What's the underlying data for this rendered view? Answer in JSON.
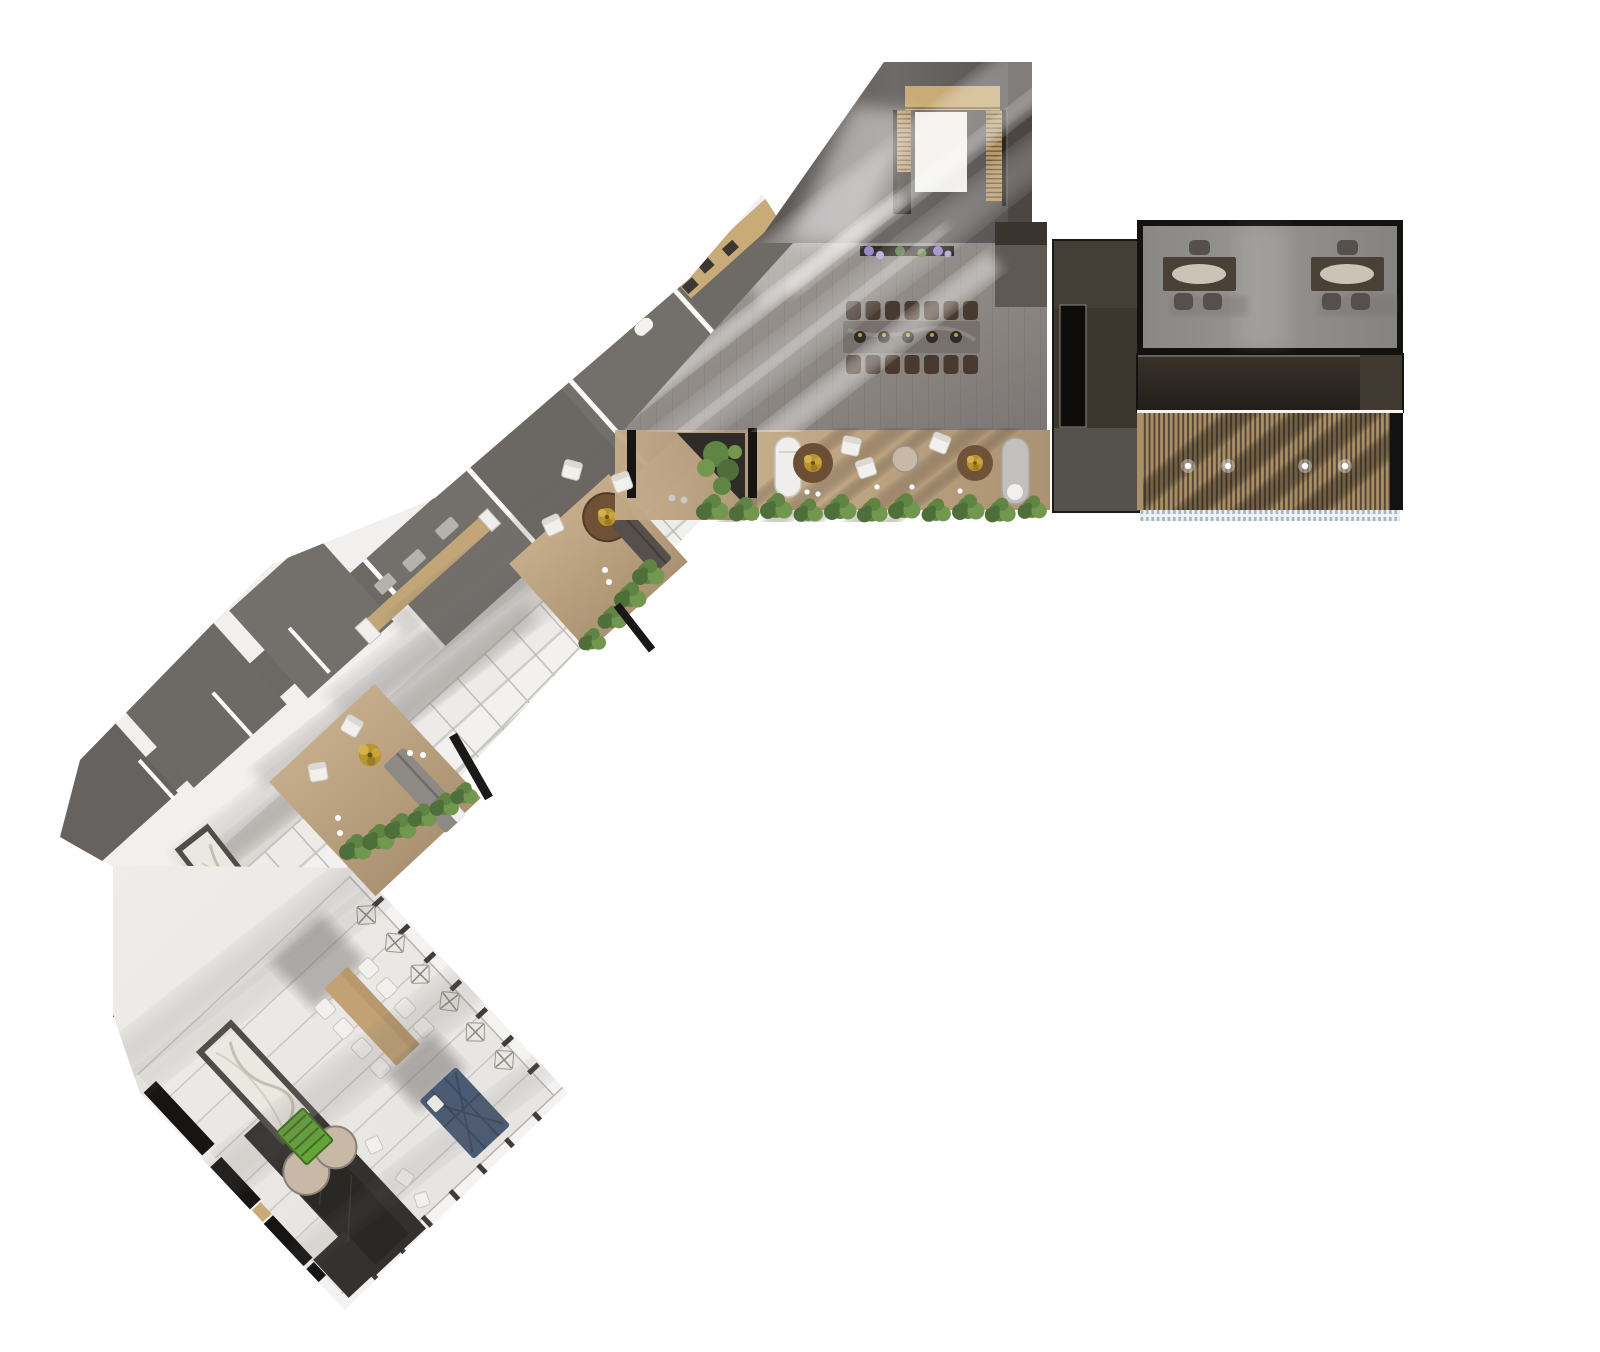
{
  "meta": {
    "title": "Rendered top-view architectural floor plan",
    "view": "orthographic roof-level render, V-shaped building on white background",
    "canvas": {
      "width": 1600,
      "height": 1352
    }
  },
  "palette": {
    "background": "#ffffff",
    "hall_light": "#a29c97",
    "hall_dark": "#7d7874",
    "troom_light": "#716d6a",
    "troom_dark": "#565150",
    "wood_light": "#c9ab78",
    "wood_counter": "#c2a678",
    "deck_light": "#c5ac8a",
    "deck_dark": "#ab9272",
    "rooms_gray": "#73706c",
    "rooms_gray_dark": "#67635f",
    "white_panel": "#f1f0ee",
    "panel_joint": "#c2bfba",
    "walkway": "#dcd9d5",
    "meeting_floor": "#8f8d8a",
    "desk_brown": "#4a4136",
    "desk_glow": "#d8d1c4",
    "chair_gray": "#55504c",
    "chair_dark": "#483a30",
    "white_chair": "#f1f0ed",
    "dark_band": "#2d2721",
    "corridor": "#3c362f",
    "corridor_light": "#55504d",
    "black_panel": "#0e0d0c",
    "louver_base": "#ab8f66",
    "louver_slat": "#453b2e",
    "fringe_blue": "#9db6c7",
    "hedge1": "#4e6f3a",
    "hedge2": "#5f8444",
    "hedge3": "#72984f",
    "marble": "#eae8e1",
    "marble_frame": "#514c47",
    "navy_sofa": "#4c5b74",
    "rug_dark": "#33302d",
    "pouf_beige": "#c8b9a7",
    "bench_green": "#66a33b",
    "black_wall": "#161514",
    "gold_plant": "#c29b3e",
    "shadow": "#6f6b67",
    "flower_purple": "#9a86c8",
    "flower_green": "#5d7d45"
  },
  "building": {
    "wings": [
      {
        "name": "north-hall-wing",
        "rooms": [
          {
            "name": "entry-stair-hall",
            "features": [
              "two stair flights with wood treads",
              "wood landing",
              "sunbeam across dark floor"
            ]
          },
          {
            "name": "main-hall",
            "features": [
              "long stone dining table",
              "14 dark chairs (7 per side)",
              "5 place settings",
              "flower planter at top wall"
            ]
          },
          {
            "name": "service-corridor",
            "features": [
              "dark roof volumes",
              "tall black door panel"
            ]
          }
        ]
      },
      {
        "name": "east-wing",
        "rooms": [
          {
            "name": "meeting-room",
            "features": [
              "2 brown desks",
              "3 chairs per desk",
              "gray floor"
            ]
          },
          {
            "name": "dark-roof-band",
            "features": [
              "flat dark roof"
            ]
          },
          {
            "name": "louvered-pergola",
            "features": [
              "vertical slats over wood deck",
              "4 downlights",
              "blue glazing fringe at south edge"
            ]
          }
        ]
      },
      {
        "name": "southwest-gallery-wing",
        "rooms": [
          {
            "name": "office-row",
            "features": [
              "row of gray-roof cabins along outer wall",
              "WC fixture",
              "small desks and stools"
            ]
          },
          {
            "name": "skylight-gallery",
            "features": [
              "white roof panels with joints",
              "long wood counter with stools"
            ]
          },
          {
            "name": "terrace",
            "features": [
              "2 lounger tubs",
              "2 round cafe tables with plants",
              "white cube seats",
              "hedge row planter"
            ]
          },
          {
            "name": "lounge-pocket-upper",
            "features": [
              "round table",
              "dark bench sofa",
              "hedge",
              "black fin wall"
            ]
          },
          {
            "name": "lounge-pocket-lower",
            "features": [
              "2 white lounge chairs",
              "gold shrub",
              "gray sofa",
              "hedge",
              "black fin wall"
            ]
          }
        ]
      },
      {
        "name": "south-garden-pavilion",
        "rooms": [
          {
            "name": "garden-room",
            "features": [
              "wood dining table with 8 white chairs",
              "navy sectional sofa",
              "6 folding chairs along glass wall",
              "dark kitchen rug with 2 round poufs",
              "2 marble counters",
              "green slatted bench",
              "black perimeter walls"
            ]
          }
        ]
      }
    ],
    "counts": {
      "hall_dining_chairs": 14,
      "hall_place_settings": 5,
      "meeting_desks": 2,
      "meeting_chairs_per_desk": 3,
      "pergola_downlights": 4,
      "garden_dining_chairs": 8,
      "folding_chairs": 6,
      "terrace_tubs": 2,
      "terrace_round_tables": 2,
      "kitchen_poufs": 2,
      "marble_counters": 2
    }
  }
}
